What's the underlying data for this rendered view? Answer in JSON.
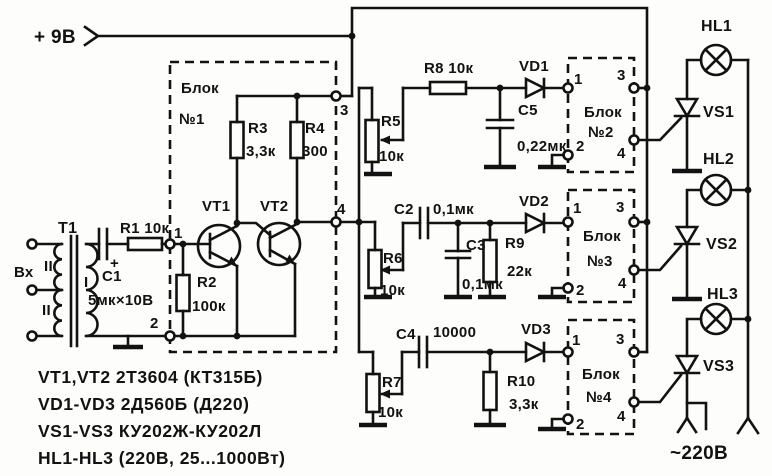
{
  "power_label": "+ 9В",
  "mains_label": "~220В",
  "input": {
    "label": "Вх",
    "transformer_ref": "Т1",
    "winding_top": "II",
    "winding_secondary": "I",
    "winding_bottom": "II"
  },
  "front": {
    "c1_ref": "С1",
    "c1_val": "5мк×10В",
    "c1_plus": "+",
    "r1_label": "R1 10к"
  },
  "block1": {
    "title_top": "Блок",
    "title_no": "№1",
    "pin1": "1",
    "pin2": "2",
    "pin3": "3",
    "pin4": "4",
    "r2_ref": "R2",
    "r2_val": "100к",
    "r3_ref": "R3",
    "r3_val": "3,3к",
    "r4_ref": "R4",
    "r4_val": "300",
    "vt1": "VT1",
    "vt2": "VT2"
  },
  "ch1": {
    "r5_ref": "R5",
    "r5_val": "10к",
    "r8_label": "R8 10к",
    "c5_ref": "С5",
    "c5_val": "0,22мк",
    "vd": "VD1"
  },
  "ch2": {
    "r6_ref": "R6",
    "r6_val": "10к",
    "c2_ref": "С2",
    "c2_val": "0,1мк",
    "c3_ref": "С3",
    "c3_val": "0,1мк",
    "r9_ref": "R9",
    "r9_val": "22к",
    "vd": "VD2"
  },
  "ch3": {
    "r7_ref": "R7",
    "r7_val": "10к",
    "c4_ref": "С4",
    "c4_val": "10000",
    "r10_ref": "R10",
    "r10_val": "3,3к",
    "vd": "VD3"
  },
  "block2": {
    "title_top": "Блок",
    "title_no": "№2",
    "pin1": "1",
    "pin2": "2",
    "pin3": "3",
    "pin4": "4"
  },
  "block3": {
    "title_top": "Блок",
    "title_no": "№3",
    "pin1": "1",
    "pin2": "2",
    "pin3": "3",
    "pin4": "4"
  },
  "block4": {
    "title_top": "Блок",
    "title_no": "№4",
    "pin1": "1",
    "pin2": "2",
    "pin3": "3",
    "pin4": "4"
  },
  "out": {
    "hl1": "HL1",
    "hl2": "HL2",
    "hl3": "HL3",
    "vs1": "VS1",
    "vs2": "VS2",
    "vs3": "VS3"
  },
  "legend": {
    "line1": "VT1,VT2 2Т3604 (КТ315Б)",
    "line2": "VD1-VD3 2Д560Б (Д220)",
    "line3": "VS1-VS3 КУ202Ж-КУ202Л",
    "line4": "HL1-HL3 (220В, 25...1000Вт)"
  }
}
